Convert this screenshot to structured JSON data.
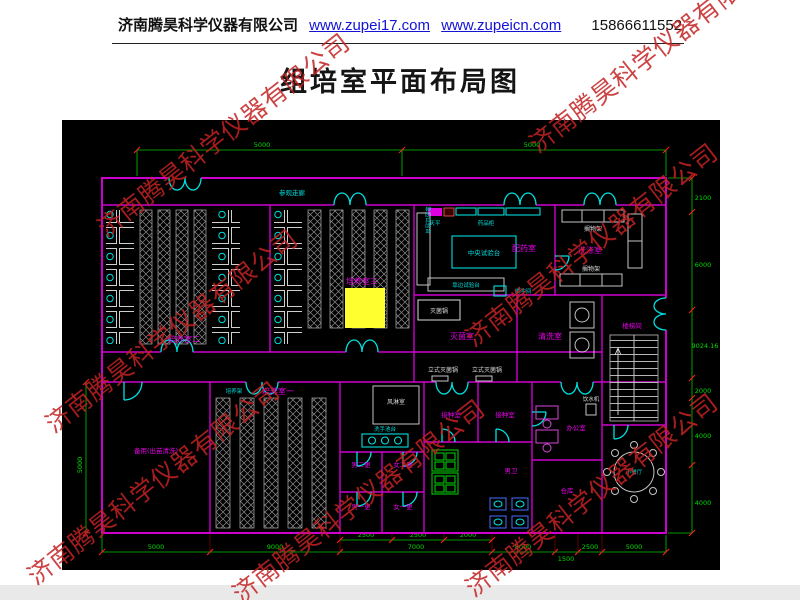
{
  "header": {
    "company": "济南腾昊科学仪器有限公司",
    "link1": "www.zupei17.com",
    "link2": "www.zupeicn.com",
    "phone": "15866611552"
  },
  "title": "组培室平面布局图",
  "watermark": {
    "text": "济南腾昊科学仪器有限公司"
  },
  "plan": {
    "corridor": "参观走廊",
    "rooms": {
      "culture1": "培养室一",
      "culture2": "培养室二",
      "culture3": "培养室三",
      "dispensing": "配药室",
      "sterilizing": "灭菌室",
      "cleaning": "清洗室",
      "washing": "洗涤室",
      "stairwell": "楼梯间",
      "inoculation1": "接种室",
      "inoculation2": "接种室",
      "office": "办公室",
      "storage": "仓库",
      "dining": "小餐厅",
      "toilet": "男卫",
      "air_shower": "风淋室",
      "change_m2": "男二更",
      "change_f2": "女二更",
      "change_m1": "男一更",
      "change_f1": "女一更",
      "spare": "备用(出苗清洗)",
      "buffer": "缓冲间"
    },
    "equipment": {
      "central_bench": "中央试验台",
      "side_bench": "靠边试验台",
      "side_bench_v": "靠边试验台",
      "balance": "天平",
      "cabinet": "药品柜",
      "autoclave": "灭菌锅",
      "vert_autoclave1": "立式灭菌锅",
      "vert_autoclave2": "立式灭菌锅",
      "rack": "培养架",
      "shelf1": "搁物架",
      "shelf2": "搁物架",
      "water": "饮水机",
      "sink": "洗手池台"
    },
    "dims": {
      "top": [
        "5000",
        "5000"
      ],
      "right": [
        "2100",
        "6000",
        "9024.16",
        "2000",
        "4000",
        "4000"
      ],
      "bottom": [
        "5000",
        "9000",
        "7000",
        "8000",
        "1500",
        "2500",
        "5000"
      ],
      "bottom_sub": [
        "2500",
        "2500",
        "2000"
      ],
      "left": [
        "5000"
      ]
    }
  },
  "colors": {
    "wall": "#cd00cd",
    "room_label": "#e800e8",
    "cyan": "#00dcdc",
    "dimension": "#00c800",
    "tick": "#ff2020",
    "highlight": "#ffff30",
    "watermark": "#c32222",
    "canvas": "#000000"
  }
}
